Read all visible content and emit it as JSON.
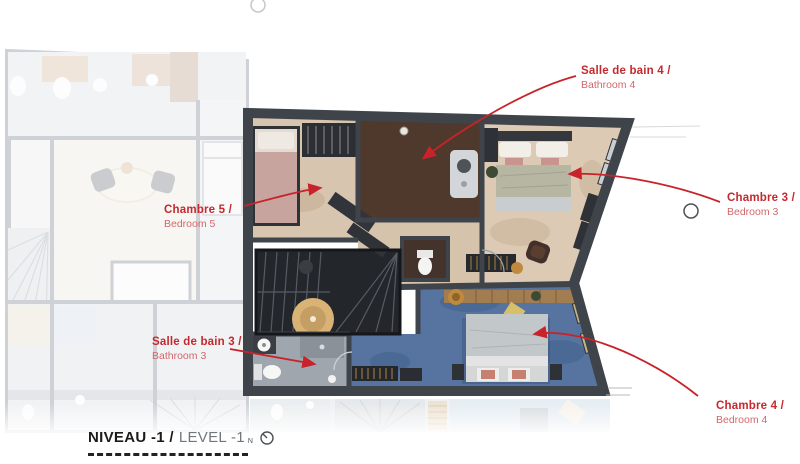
{
  "title_block": {
    "title_fr": "NIVEAU -1 /",
    "title_en": "LEVEL -1",
    "compass_letter": "N"
  },
  "room_labels": [
    {
      "id": "bathroom-4",
      "name_fr": "Salle de bain 4 /",
      "name_en": "Bathroom 4"
    },
    {
      "id": "bedroom-5",
      "name_fr": "Chambre 5 /",
      "name_en": "Bedroom 5"
    },
    {
      "id": "bedroom-3",
      "name_fr": "Chambre 3 /",
      "name_en": "Bedroom 3"
    },
    {
      "id": "bathroom-3",
      "name_fr": "Salle de bain 3 /",
      "name_en": "Bathroom 3"
    },
    {
      "id": "bedroom-4",
      "name_fr": "Chambre 4 /",
      "name_en": "Bedroom 4"
    }
  ],
  "colors": {
    "label_accent": "#c3292e",
    "label_secondary": "#d2686c",
    "leader_line": "#c8232a",
    "wall": "#3f444b",
    "floor_beige": "#d7c5af",
    "floor_blue": "#56749f",
    "floor_brown": "#4f392c",
    "floor_grey": "#a0a6ae"
  }
}
